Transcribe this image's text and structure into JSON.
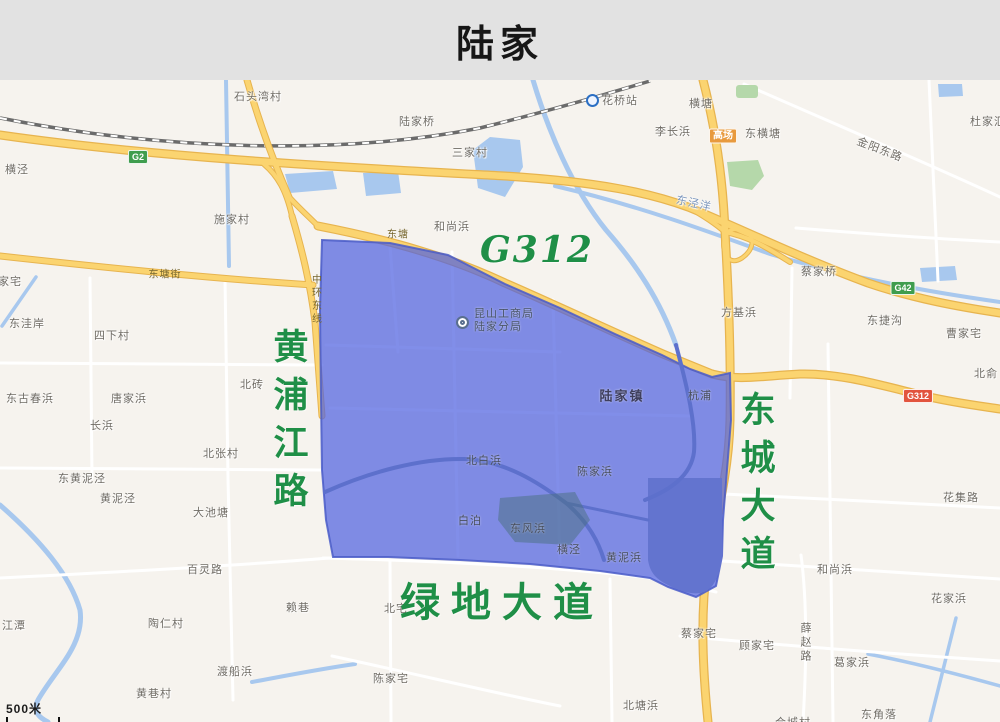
{
  "title": "陆家",
  "map": {
    "big_roads": {
      "huangpu": "黄浦江路",
      "dongcheng": "东城大道",
      "lvdi": "绿地大道",
      "g312_text": "G312"
    },
    "badges": {
      "g2": "G2",
      "g42": "G42",
      "g312": "G312",
      "gaochang": "高场"
    },
    "poi": {
      "line1": "昆山工商局",
      "line2": "陆家分局"
    },
    "town_label": "陆家镇",
    "scale": {
      "text": "500米"
    },
    "colors": {
      "header_bg": "#e2e2e2",
      "accent_green": "#1f8f47",
      "region_fill": "#5062e1",
      "road_yellow": "#fbd470",
      "water": "#a8c8ee"
    },
    "labels": [
      {
        "t": "石头湾村",
        "x": 258,
        "y": 96
      },
      {
        "t": "横泾",
        "x": 17,
        "y": 169
      },
      {
        "t": "施家村",
        "x": 232,
        "y": 219
      },
      {
        "t": "陆家桥",
        "x": 417,
        "y": 121
      },
      {
        "t": "三家村",
        "x": 470,
        "y": 152
      },
      {
        "t": "花桥站",
        "x": 620,
        "y": 100
      },
      {
        "t": "李长浜",
        "x": 673,
        "y": 131
      },
      {
        "t": "横塘",
        "x": 701,
        "y": 103
      },
      {
        "t": "东横塘",
        "x": 763,
        "y": 133
      },
      {
        "t": "金阳东路",
        "x": 880,
        "y": 149,
        "r": 21
      },
      {
        "t": "杜家汇",
        "x": 988,
        "y": 121
      },
      {
        "t": "东泾洋",
        "x": 694,
        "y": 203,
        "c": "w",
        "r": 12
      },
      {
        "t": "蔡家桥",
        "x": 819,
        "y": 271
      },
      {
        "t": "方基浜",
        "x": 739,
        "y": 312
      },
      {
        "t": "东捷沟",
        "x": 885,
        "y": 320
      },
      {
        "t": "曹家宅",
        "x": 964,
        "y": 333
      },
      {
        "t": "北俞",
        "x": 986,
        "y": 373
      },
      {
        "t": "杭浦",
        "x": 700,
        "y": 395,
        "c": "b"
      },
      {
        "t": "东洼岸",
        "x": 27,
        "y": 323
      },
      {
        "t": "四下村",
        "x": 112,
        "y": 335
      },
      {
        "t": "北砖",
        "x": 252,
        "y": 384
      },
      {
        "t": "东古春浜",
        "x": 30,
        "y": 398
      },
      {
        "t": "唐家浜",
        "x": 129,
        "y": 398
      },
      {
        "t": "长浜",
        "x": 102,
        "y": 425
      },
      {
        "t": "北张村",
        "x": 221,
        "y": 453
      },
      {
        "t": "东黄泥泾",
        "x": 82,
        "y": 478
      },
      {
        "t": "黄泥泾",
        "x": 118,
        "y": 498
      },
      {
        "t": "大池塘",
        "x": 211,
        "y": 512
      },
      {
        "t": "百灵路",
        "x": 205,
        "y": 569
      },
      {
        "t": "江潭",
        "x": 14,
        "y": 625
      },
      {
        "t": "陶仁村",
        "x": 166,
        "y": 623
      },
      {
        "t": "赖巷",
        "x": 298,
        "y": 607
      },
      {
        "t": "渡船浜",
        "x": 235,
        "y": 671
      },
      {
        "t": "黄巷村",
        "x": 154,
        "y": 693
      },
      {
        "t": "北宅",
        "x": 396,
        "y": 608
      },
      {
        "t": "陈家宅",
        "x": 391,
        "y": 678
      },
      {
        "t": "北塘浜",
        "x": 641,
        "y": 705
      },
      {
        "t": "东角落",
        "x": 879,
        "y": 714
      },
      {
        "t": "合城村",
        "x": 793,
        "y": 722
      },
      {
        "t": "白泊",
        "x": 470,
        "y": 520,
        "c": "b"
      },
      {
        "t": "东风浜",
        "x": 528,
        "y": 528,
        "c": "b"
      },
      {
        "t": "横泾",
        "x": 569,
        "y": 549,
        "c": "b"
      },
      {
        "t": "黄泥浜",
        "x": 624,
        "y": 557,
        "c": "b"
      },
      {
        "t": "陈家浜",
        "x": 595,
        "y": 471,
        "c": "b"
      },
      {
        "t": "北白浜",
        "x": 484,
        "y": 460,
        "c": "b"
      },
      {
        "t": "和尚浜",
        "x": 452,
        "y": 226
      },
      {
        "t": "东塘",
        "x": 398,
        "y": 233,
        "c": "y"
      },
      {
        "t": "东塘街",
        "x": 165,
        "y": 273,
        "c": "y"
      },
      {
        "t": "花集路",
        "x": 961,
        "y": 497
      },
      {
        "t": "和尚浜",
        "x": 835,
        "y": 569
      },
      {
        "t": "花家浜",
        "x": 949,
        "y": 598
      },
      {
        "t": "蔡家宅",
        "x": 699,
        "y": 633
      },
      {
        "t": "顾家宅",
        "x": 757,
        "y": 645
      },
      {
        "t": "葛家浜",
        "x": 852,
        "y": 662
      },
      {
        "t": "家宅",
        "x": 10,
        "y": 281
      },
      {
        "t": "中环东线",
        "x": 315,
        "y": 300,
        "v": 1,
        "c": "y"
      },
      {
        "t": "薛赵路",
        "x": 805,
        "y": 643,
        "v": 1
      }
    ]
  }
}
